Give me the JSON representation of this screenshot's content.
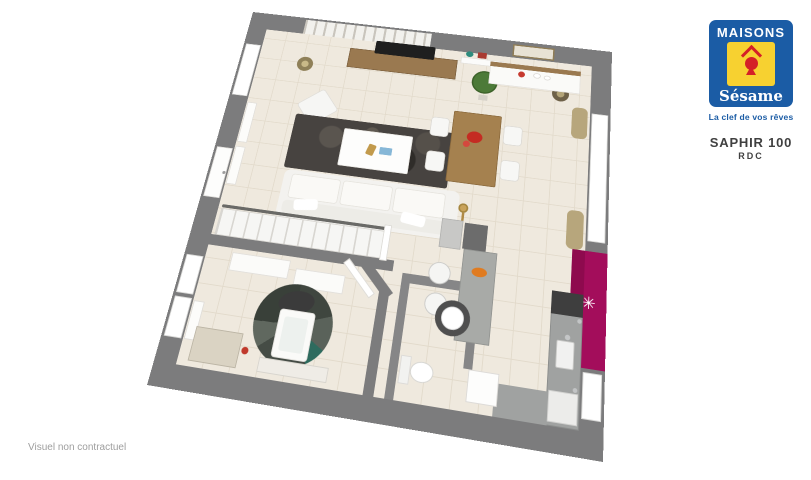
{
  "branding": {
    "logo_title": "MAISONS",
    "logo_subtitle": "Sésame",
    "tagline": "La clef de vos rêves",
    "colors": {
      "blue": "#1B5CA5",
      "yellow": "#F7D130",
      "red": "#D42027"
    }
  },
  "plan_header": {
    "model": "SAPHIR 100",
    "level": "RDC"
  },
  "footer": {
    "disclaimer": "Visuel non contractuel"
  },
  "floor_plan": {
    "type": "3d-floor-plan",
    "palette": {
      "wall_gray": "#7C7C7D",
      "floor_beige": "#EFE9DE",
      "accent_magenta": "#A30D5B",
      "wood": "#A5814F",
      "rug_dark": "#474340",
      "counter_gray": "#A0A2A1"
    },
    "elements": [
      {
        "name": "wall-slab",
        "x": 0,
        "y": 0,
        "w": 500,
        "h": 500,
        "color": "#7C7C7D"
      },
      {
        "name": "floor-tiles",
        "x": 26,
        "y": 26,
        "w": 448,
        "h": 448,
        "cls": "tiles"
      },
      {
        "name": "birch-wallpaper",
        "x": 78,
        "y": 3,
        "w": 178,
        "h": 23,
        "cls": "birch"
      },
      {
        "name": "wall-mirror",
        "x": 368,
        "y": 5,
        "w": 56,
        "h": 19,
        "color": "#E8E2D4",
        "border": "2px solid #8F7C55"
      },
      {
        "name": "window-left-living",
        "x": 3,
        "y": 52,
        "w": 21,
        "h": 80,
        "color": "#FFFFFF",
        "border": "1px solid #D8D8D6"
      },
      {
        "name": "front-door",
        "x": 3,
        "y": 208,
        "w": 21,
        "h": 68,
        "color": "#FDFDFC",
        "border": "1px solid #DDDBD8"
      },
      {
        "name": "front-door-handle",
        "x": 19,
        "y": 240,
        "w": 4,
        "h": 4,
        "shape": "circle",
        "color": "#9C9C9C"
      },
      {
        "name": "window-bedroom-1",
        "x": 3,
        "y": 350,
        "w": 21,
        "h": 46,
        "color": "#FFFFFF",
        "border": "1px solid #D8D8D6"
      },
      {
        "name": "window-bedroom-2",
        "x": 3,
        "y": 400,
        "w": 21,
        "h": 46,
        "color": "#FFFFFF",
        "border": "1px solid #D8D8D6"
      },
      {
        "name": "window-right-living",
        "x": 476,
        "y": 96,
        "w": 21,
        "h": 170,
        "color": "#FFFFFF",
        "border": "1px solid #D8D8D6"
      },
      {
        "name": "window-right-kitchen",
        "x": 476,
        "y": 414,
        "w": 21,
        "h": 48,
        "color": "#FFFFFF",
        "border": "1px solid #D8D8D6"
      },
      {
        "name": "magenta-accent-wall",
        "x": 474,
        "y": 278,
        "w": 26,
        "h": 132,
        "color": "#A30D5B"
      },
      {
        "name": "magenta-wall-face",
        "x": 459,
        "y": 278,
        "w": 15,
        "h": 132,
        "color": "#8E0A4E"
      },
      {
        "name": "clock-decal",
        "x": 465,
        "y": 324,
        "w": 30,
        "h": 30,
        "char": "✳",
        "fs": 19,
        "color": "#FFFFFF"
      },
      {
        "name": "curtain-top-right",
        "x": 451,
        "y": 90,
        "w": 20,
        "h": 44,
        "color": "#B7A67C",
        "r": 7
      },
      {
        "name": "curtain-bottom-right",
        "x": 451,
        "y": 230,
        "w": 20,
        "h": 48,
        "color": "#B7A67C",
        "r": 7
      },
      {
        "name": "bedroom-wall-top",
        "x": 26,
        "y": 322,
        "w": 226,
        "h": 13,
        "color": "#7C7C7D"
      },
      {
        "name": "bedroom-wall-chamfer",
        "x": 201,
        "y": 337,
        "w": 60,
        "h": 12,
        "color": "#7C7C7D",
        "rot": 45
      },
      {
        "name": "bedroom-wall-right",
        "x": 240,
        "y": 358,
        "w": 12,
        "h": 116,
        "color": "#7C7C7D"
      },
      {
        "name": "wc-wall-top",
        "x": 264,
        "y": 335,
        "w": 92,
        "h": 11,
        "color": "#868687"
      },
      {
        "name": "wc-wall-left",
        "x": 264,
        "y": 346,
        "w": 10,
        "h": 128,
        "color": "#868687"
      },
      {
        "name": "wc-wall-right",
        "x": 346,
        "y": 346,
        "w": 10,
        "h": 84,
        "color": "#868687"
      },
      {
        "name": "radiator-living-1",
        "x": 27,
        "y": 140,
        "w": 13,
        "h": 58,
        "color": "#FCFCFA",
        "border": "1px solid #E0DEDA"
      },
      {
        "name": "radiator-living-2",
        "x": 27,
        "y": 204,
        "w": 13,
        "h": 52,
        "color": "#FCFCFA",
        "border": "1px solid #E0DEDA"
      },
      {
        "name": "radiator-bedroom",
        "x": 27,
        "y": 402,
        "w": 13,
        "h": 44,
        "color": "#FCFCFA",
        "border": "1px solid #E0DEDA"
      },
      {
        "name": "tv-console",
        "x": 148,
        "y": 40,
        "w": 148,
        "h": 30,
        "color": "#9A7950",
        "border": "1px solid #7A5E3C"
      },
      {
        "name": "tv",
        "x": 182,
        "y": 24,
        "w": 82,
        "h": 20,
        "color": "#1F1F1F",
        "r": 2
      },
      {
        "name": "wall-shelf",
        "x": 300,
        "y": 34,
        "w": 58,
        "h": 10,
        "color": "#FBFBFA",
        "border": "1px solid #E2E0DC"
      },
      {
        "name": "shelf-plant",
        "x": 306,
        "y": 24,
        "w": 10,
        "h": 9,
        "shape": "circle",
        "color": "#2E8C7E"
      },
      {
        "name": "shelf-books",
        "x": 322,
        "y": 24,
        "w": 12,
        "h": 9,
        "color": "#A93B31",
        "r": 1
      },
      {
        "name": "floor-plant",
        "x": 318,
        "y": 52,
        "w": 34,
        "h": 34,
        "shape": "circle",
        "color": "#4C7A38",
        "border": "2px solid #3C6129"
      },
      {
        "name": "plant-pot",
        "x": 329,
        "y": 88,
        "w": 12,
        "h": 8,
        "color": "#D6D2C9"
      },
      {
        "name": "floor-lamp-left",
        "x": 80,
        "y": 62,
        "w": 22,
        "h": 22,
        "shape": "circle",
        "color": "#C9B988",
        "border": "6px solid #8F8058"
      },
      {
        "name": "floor-lamp-right",
        "x": 424,
        "y": 62,
        "w": 22,
        "h": 22,
        "shape": "circle",
        "color": "#B3A478",
        "border": "6px solid #6E6148"
      },
      {
        "name": "sideboard",
        "x": 340,
        "y": 36,
        "w": 120,
        "h": 34,
        "color": "#FAFAF8",
        "border": "1px solid #E4E2DE"
      },
      {
        "name": "sideboard-top",
        "x": 340,
        "y": 36,
        "w": 120,
        "h": 7,
        "color": "#9A7950"
      },
      {
        "name": "sideboard-flower",
        "x": 378,
        "y": 46,
        "w": 9,
        "h": 9,
        "shape": "circle",
        "color": "#C63A2F"
      },
      {
        "name": "sideboard-vase-1",
        "x": 398,
        "y": 46,
        "w": 10,
        "h": 8,
        "shape": "circle",
        "color": "#FFFFFF",
        "border": "1px solid #D8D6D2"
      },
      {
        "name": "sideboard-vase-2",
        "x": 412,
        "y": 48,
        "w": 9,
        "h": 7,
        "shape": "circle",
        "color": "#FFFFFF",
        "border": "1px solid #D8D6D2"
      },
      {
        "name": "armchair",
        "x": 100,
        "y": 116,
        "w": 42,
        "h": 38,
        "color": "#F6F6F4",
        "border": "1px solid #DFDDD8",
        "r": 4,
        "rot": -40
      },
      {
        "name": "living-rug",
        "x": 95,
        "y": 148,
        "w": 208,
        "h": 76,
        "cls": "rug",
        "r": 3
      },
      {
        "name": "coffee-table",
        "x": 162,
        "y": 160,
        "w": 90,
        "h": 52,
        "color": "#FDFDFC",
        "border": "1px solid #E8E6E1",
        "r": 2
      },
      {
        "name": "coffee-decor-gold",
        "x": 196,
        "y": 178,
        "w": 10,
        "h": 15,
        "color": "#C29A4C",
        "rot": 15,
        "r": 2
      },
      {
        "name": "coffee-decor-book",
        "x": 212,
        "y": 180,
        "w": 16,
        "h": 10,
        "color": "#86B7D7",
        "r": 1
      },
      {
        "name": "sofa-base",
        "x": 98,
        "y": 226,
        "w": 222,
        "h": 62,
        "color": "#F3F2EF",
        "r": 8
      },
      {
        "name": "sofa-seat-1",
        "x": 108,
        "y": 231,
        "w": 63,
        "h": 32,
        "color": "#FAF9F6",
        "border": "1px solid #E6E4DE",
        "r": 4
      },
      {
        "name": "sofa-seat-2",
        "x": 174,
        "y": 231,
        "w": 63,
        "h": 32,
        "color": "#FAF9F6",
        "border": "1px solid #E6E4DE",
        "r": 4
      },
      {
        "name": "sofa-seat-3",
        "x": 240,
        "y": 231,
        "w": 63,
        "h": 32,
        "color": "#FAF9F6",
        "border": "1px solid #E6E4DE",
        "r": 4
      },
      {
        "name": "sofa-back",
        "x": 104,
        "y": 266,
        "w": 210,
        "h": 17,
        "color": "#EDECE7",
        "r": 6
      },
      {
        "name": "sofa-pillow-1",
        "x": 118,
        "y": 262,
        "w": 30,
        "h": 14,
        "color": "#FFFFFF",
        "r": 4,
        "rot": -8
      },
      {
        "name": "sofa-pillow-2",
        "x": 252,
        "y": 262,
        "w": 30,
        "h": 14,
        "color": "#FFFFFF",
        "r": 4,
        "rot": 7
      },
      {
        "name": "gold-floor-lamp",
        "x": 320,
        "y": 240,
        "w": 12,
        "h": 12,
        "shape": "circle",
        "color": "#C9A35B",
        "border": "2px solid #A5863F"
      },
      {
        "name": "gold-lamp-stem",
        "x": 325,
        "y": 252,
        "w": 3,
        "h": 12,
        "color": "#B08A45"
      },
      {
        "name": "staircase",
        "x": 30,
        "y": 288,
        "w": 206,
        "h": 34,
        "cls": "stairs",
        "border": "1px solid #D8D6D1"
      },
      {
        "name": "stair-handrail",
        "x": 30,
        "y": 283,
        "w": 206,
        "h": 4,
        "color": "#6A6A67",
        "r": 2
      },
      {
        "name": "stair-newel",
        "x": 234,
        "y": 280,
        "w": 9,
        "h": 44,
        "color": "#FFFFFF",
        "border": "1px solid #DDDBD6"
      },
      {
        "name": "dining-table",
        "x": 300,
        "y": 116,
        "w": 62,
        "h": 98,
        "color": "#A5814F",
        "border": "1px solid #8A693C",
        "r": 2,
        "cls": "wood"
      },
      {
        "name": "table-flowers",
        "x": 320,
        "y": 142,
        "w": 20,
        "h": 16,
        "shape": "circle",
        "color": "#C42B22"
      },
      {
        "name": "table-flower-2",
        "x": 316,
        "y": 156,
        "w": 9,
        "h": 9,
        "shape": "circle",
        "color": "#D4483E"
      },
      {
        "name": "dining-chair-1",
        "x": 272,
        "y": 128,
        "w": 24,
        "h": 27,
        "color": "#F7F7F5",
        "border": "1px solid #DCDAD5",
        "r": 5
      },
      {
        "name": "dining-chair-2",
        "x": 272,
        "y": 176,
        "w": 24,
        "h": 27,
        "color": "#F7F7F5",
        "border": "1px solid #DCDAD5",
        "r": 5
      },
      {
        "name": "dining-chair-3",
        "x": 366,
        "y": 128,
        "w": 24,
        "h": 27,
        "color": "#F7F7F5",
        "border": "1px solid #DCDAD5",
        "r": 5
      },
      {
        "name": "dining-chair-4",
        "x": 366,
        "y": 176,
        "w": 24,
        "h": 27,
        "color": "#F7F7F5",
        "border": "1px solid #DCDAD5",
        "r": 5
      },
      {
        "name": "kitchen-counter-right",
        "x": 438,
        "y": 330,
        "w": 36,
        "h": 144,
        "color": "#A0A2A1",
        "border": "1px solid #8B8D8C"
      },
      {
        "name": "kitchen-appliance",
        "x": 438,
        "y": 330,
        "w": 36,
        "h": 26,
        "color": "#3E3E3E"
      },
      {
        "name": "kitchen-sink",
        "x": 446,
        "y": 384,
        "w": 20,
        "h": 30,
        "color": "#F1F1F0",
        "border": "1px solid #C9C9C7",
        "r": 2
      },
      {
        "name": "sink-faucet",
        "x": 455,
        "y": 377,
        "w": 6,
        "h": 6,
        "shape": "circle",
        "color": "#C4C6C7"
      },
      {
        "name": "kitchen-dishwasher",
        "x": 440,
        "y": 438,
        "w": 32,
        "h": 32,
        "color": "#ECECEA",
        "border": "1px solid #D2D2D0"
      },
      {
        "name": "kitchen-counter-bottom",
        "x": 382,
        "y": 440,
        "w": 58,
        "h": 34,
        "color": "#A0A2A1"
      },
      {
        "name": "kitchen-bar",
        "x": 332,
        "y": 296,
        "w": 40,
        "h": 106,
        "color": "#A8AAA7",
        "border": "1px solid #939592"
      },
      {
        "name": "bar-dish",
        "x": 344,
        "y": 316,
        "w": 18,
        "h": 11,
        "shape": "circle",
        "color": "#E07B20"
      },
      {
        "name": "kitchen-column",
        "x": 330,
        "y": 264,
        "w": 28,
        "h": 32,
        "color": "#6C6C6C"
      },
      {
        "name": "kitchen-tall-unit",
        "x": 302,
        "y": 262,
        "w": 26,
        "h": 36,
        "color": "#C8C8C6",
        "border": "1px solid #B2B2B0"
      },
      {
        "name": "bar-stool-1",
        "x": 294,
        "y": 316,
        "w": 26,
        "h": 26,
        "shape": "circle",
        "color": "#F5F5F3",
        "border": "1px solid #C9C9C7"
      },
      {
        "name": "bar-stool-2",
        "x": 294,
        "y": 352,
        "w": 26,
        "h": 26,
        "shape": "circle",
        "color": "#F5F5F3",
        "border": "1px solid #C9C9C7"
      },
      {
        "name": "wall-fixture-1",
        "x": 468,
        "y": 358,
        "w": 5,
        "h": 5,
        "shape": "circle",
        "color": "#C2C4C5"
      },
      {
        "name": "wall-fixture-2",
        "x": 466,
        "y": 432,
        "w": 5,
        "h": 5,
        "shape": "circle",
        "color": "#C2C4C5"
      },
      {
        "name": "bedroom-shelf-1",
        "x": 58,
        "y": 340,
        "w": 72,
        "h": 22,
        "color": "#FBFBF9",
        "border": "1px solid #E2E0DC"
      },
      {
        "name": "bedroom-shelf-2",
        "x": 138,
        "y": 348,
        "w": 60,
        "h": 22,
        "color": "#FBFBF9",
        "border": "1px solid #E2E0DC"
      },
      {
        "name": "bedroom-round-rug",
        "x": 102,
        "y": 366,
        "w": 92,
        "h": 92,
        "shape": "circle",
        "cls": "round-rug"
      },
      {
        "name": "office-chair",
        "x": 126,
        "y": 374,
        "w": 42,
        "h": 26,
        "shape": "circle",
        "color": "#3B3B3B",
        "rot": -12
      },
      {
        "name": "desk",
        "x": 130,
        "y": 396,
        "w": 42,
        "h": 54,
        "color": "#FAFAF8",
        "border": "1px solid #E3E1DD",
        "r": 4
      },
      {
        "name": "desk-top-glass",
        "x": 137,
        "y": 404,
        "w": 28,
        "h": 38,
        "color": "#EDF1EE",
        "r": 3
      },
      {
        "name": "bedroom-cabinet",
        "x": 38,
        "y": 430,
        "w": 56,
        "h": 38,
        "color": "#DAD3C3",
        "border": "1px solid #BCB5A5"
      },
      {
        "name": "cabinet-red-decor",
        "x": 96,
        "y": 444,
        "w": 8,
        "h": 8,
        "shape": "circle",
        "color": "#C0392B"
      },
      {
        "name": "bedroom-console",
        "x": 118,
        "y": 452,
        "w": 80,
        "h": 16,
        "color": "#EFECE6",
        "border": "1px solid #D8D5CE"
      },
      {
        "name": "bedroom-door",
        "x": 188,
        "y": 344,
        "w": 52,
        "h": 9,
        "color": "#FFFFFF",
        "border": "1px solid #DDDBD6",
        "rot": 45
      },
      {
        "name": "toilet-tank",
        "x": 276,
        "y": 426,
        "w": 12,
        "h": 30,
        "color": "#F2F2F0",
        "border": "1px solid #DDDBD8"
      },
      {
        "name": "toilet-bowl",
        "x": 288,
        "y": 430,
        "w": 26,
        "h": 22,
        "shape": "circle",
        "color": "#FFFFFF",
        "border": "1px solid #D5D5D2"
      },
      {
        "name": "wc-basin-pedestal",
        "x": 308,
        "y": 358,
        "w": 40,
        "h": 40,
        "shape": "circle",
        "color": "#4F4F4F"
      },
      {
        "name": "wc-basin",
        "x": 315,
        "y": 365,
        "w": 26,
        "h": 26,
        "shape": "circle",
        "color": "#FFFFFF",
        "border": "1px solid #E0E0E0"
      },
      {
        "name": "wc-door-open",
        "x": 352,
        "y": 430,
        "w": 34,
        "h": 34,
        "color": "#FDFDFC",
        "border": "1px solid #DDDBD8"
      }
    ]
  }
}
